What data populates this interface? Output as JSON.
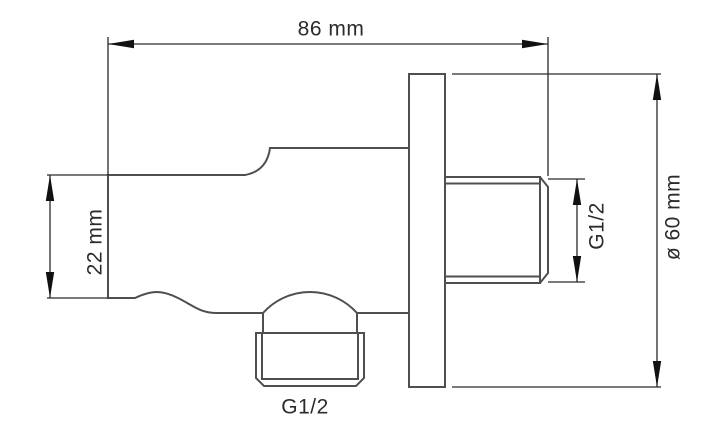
{
  "drawing": {
    "dimension_labels": {
      "overall_depth": "86 mm",
      "body_height": "22 mm",
      "wall_thread": "G1/2",
      "outlet_thread": "G1/2",
      "plate_diameter": "ø 60 mm"
    },
    "colors": {
      "background": "#ffffff",
      "part_outline": "#4f4f4f",
      "dimension_lines": "#2a2a2a",
      "arrowheads": "#111111",
      "text": "#2b2b2b"
    }
  }
}
